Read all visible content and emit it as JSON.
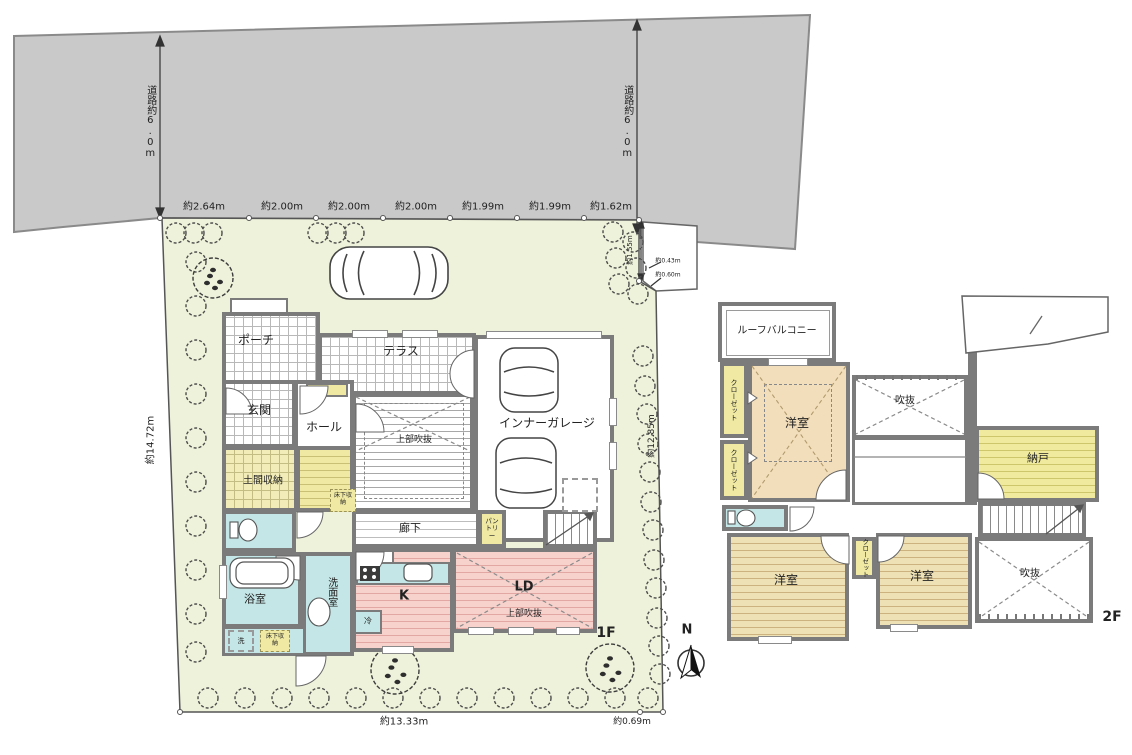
{
  "site": {
    "road_label_left": "道路約6.0m",
    "road_label_right": "道路約6.0m",
    "top_dimensions": [
      "約2.64m",
      "約2.00m",
      "約2.00m",
      "約2.00m",
      "約1.99m",
      "約1.99m",
      "約1.62m"
    ],
    "corner_dimensions": {
      "v": "約1.55m",
      "a": "約0.43m",
      "b": "約0.60m"
    },
    "left_dimension": "約14.72m",
    "right_dimension": "約12.85m",
    "bottom_dimension_main": "約13.33m",
    "bottom_dimension_side": "約0.69m"
  },
  "floor1": {
    "floor_label": "1F",
    "rooms": {
      "porch": "ポーチ",
      "terrace": "テラス",
      "garage": "インナーガレージ",
      "entrance": "玄関",
      "hall": "ホール",
      "upper_void_1": "上部吹抜",
      "doma_storage": "土間収納",
      "underfloor_1": "床下収納",
      "corridor": "廊下",
      "pantry": "パントリー",
      "bathroom": "浴室",
      "washroom": "洗面室",
      "washer": "洗",
      "underfloor_2": "床下収納",
      "kitchen": "K",
      "fridge": "冷",
      "living_dining": "LD",
      "upper_void_2": "上部吹抜"
    }
  },
  "floor2": {
    "floor_label": "2F",
    "rooms": {
      "roof_balcony": "ルーフバルコニー",
      "closet_1": "クローゼット",
      "closet_2": "クローゼット",
      "bedroom_1": "洋室",
      "void_1": "吹抜",
      "storeroom": "納戸",
      "bedroom_2": "洋室",
      "closet_3": "クローゼット",
      "bedroom_3": "洋室",
      "void_2": "吹抜"
    }
  },
  "compass": {
    "north": "N"
  },
  "colors": {
    "road": "#c9c9c9",
    "site_green": "#eef2da",
    "wall_gray": "#7b7b7b",
    "water_blue": "#c5e6e6",
    "storage_yellow": "#efe9a3",
    "ld_pink": "#f7d2cd",
    "room_tan": "#f3debb"
  }
}
